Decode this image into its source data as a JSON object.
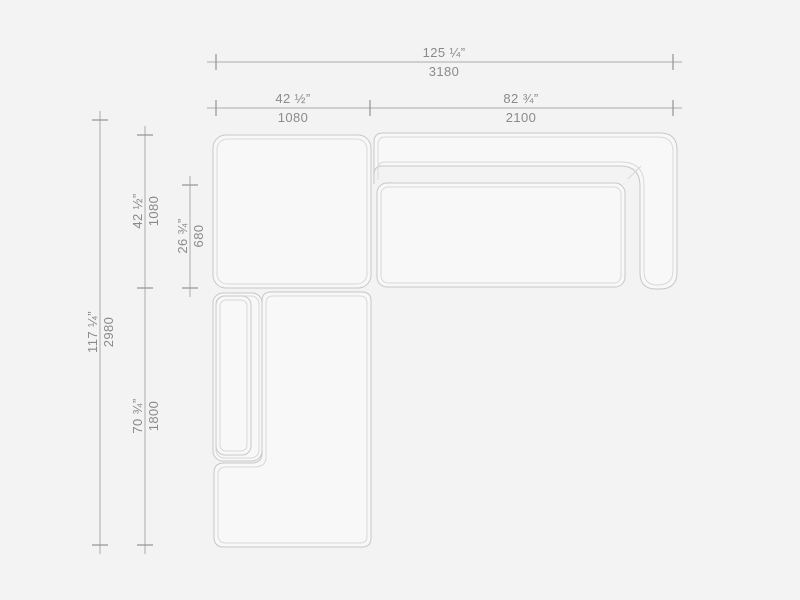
{
  "page": {
    "background": "#f3f3f3",
    "description": "Top-view technical dimension drawing of a modular sectional sofa with corner module and chaise"
  },
  "colors": {
    "background": "#f3f3f3",
    "piece_fill": "#f8f8f8",
    "outline": "#c7c7c7",
    "outline_light": "#d8d8d8",
    "dim_line": "#ababab",
    "tick": "#9a9a9a",
    "label": "#8a8a8a"
  },
  "dimensions": {
    "total_width": {
      "inches": "125 ¼”",
      "mm": "3180"
    },
    "corner_module_width": {
      "inches": "42 ½”",
      "mm": "1080"
    },
    "sofa_module_width": {
      "inches": "82 ¾”",
      "mm": "2100"
    },
    "total_depth": {
      "inches": "117 ¼”",
      "mm": "2980"
    },
    "corner_module_depth": {
      "inches": "42 ½”",
      "mm": "1080"
    },
    "seat_depth": {
      "inches": "26 ¾”",
      "mm": "680"
    },
    "chaise_length": {
      "inches": "70 ¾”",
      "mm": "1800"
    }
  }
}
